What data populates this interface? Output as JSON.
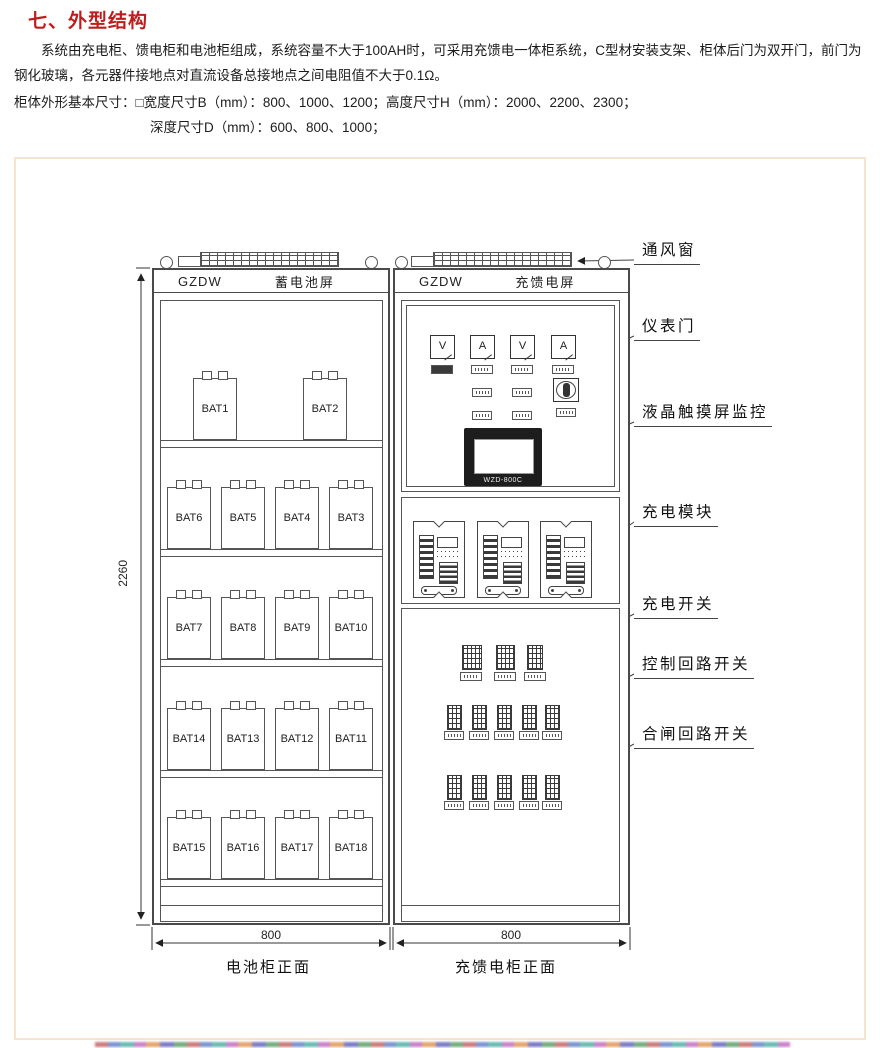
{
  "header": {
    "title": "七、外型结构",
    "paragraph": "系统由充电柜、馈电柜和电池柜组成，系统容量不大于100AH时，可采用充馈电一体柜系统，C型材安装支架、柜体后门为双开门，前门为钢化玻璃，各元器件接地点对直流设备总接地点之间电阻值不大于0.1Ω。",
    "dims_line1": "柜体外形基本尺寸：□宽度尺寸B（mm）：800、1000、1200；高度尺寸H（mm）：2000、2200、2300；",
    "dims_line2": "深度尺寸D（mm）：600、800、1000；"
  },
  "diagram": {
    "left_cabinet": {
      "brand": "GZDW",
      "title": "蓄电池屏"
    },
    "right_cabinet": {
      "brand": "GZDW",
      "title": "充馈电屏"
    },
    "screen_model": "WZD-800C",
    "meters": [
      "V",
      "A",
      "V",
      "A"
    ],
    "battery_rows": [
      [
        "BAT1",
        "BAT2"
      ],
      [
        "BAT6",
        "BAT5",
        "BAT4",
        "BAT3"
      ],
      [
        "BAT7",
        "BAT8",
        "BAT9",
        "BAT10"
      ],
      [
        "BAT14",
        "BAT13",
        "BAT12",
        "BAT11"
      ],
      [
        "BAT15",
        "BAT16",
        "BAT17",
        "BAT18"
      ]
    ],
    "callouts": {
      "vent": "通风窗",
      "meter_door": "仪表门",
      "lcd": "液晶触摸屏监控",
      "charge_module": "充电模块",
      "charge_switch": "充电开关",
      "control_switch": "控制回路开关",
      "closing_switch": "合闸回路开关"
    },
    "dimensions": {
      "height": "2260",
      "left_width": "800",
      "right_width": "800"
    },
    "captions": {
      "left": "电池柜正面",
      "right": "充馈电柜正面"
    }
  }
}
